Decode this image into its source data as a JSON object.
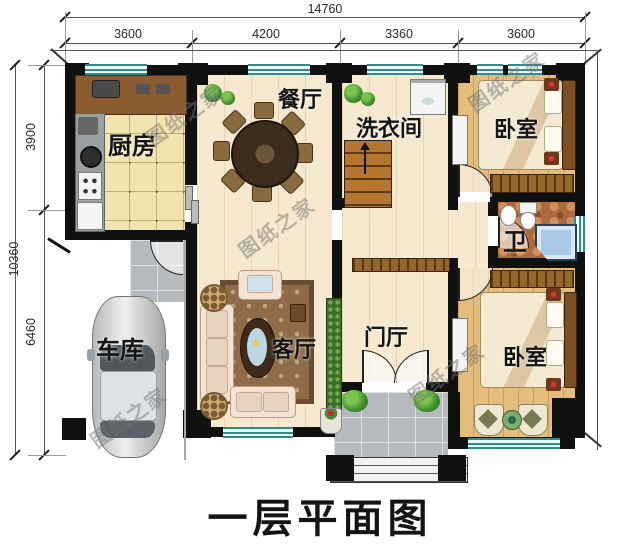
{
  "title": "一层平面图",
  "watermark": "图纸之家",
  "dims": {
    "top_total": "14760",
    "top_segments": [
      "3600",
      "4200",
      "3360",
      "3600"
    ],
    "left_total": "10360",
    "left_segments": [
      "3900",
      "6460"
    ]
  },
  "rooms": {
    "kitchen": "厨房",
    "dining": "餐厅",
    "laundry": "洗衣间",
    "bedroom_top": "卧室",
    "bath": "卫",
    "living": "客厅",
    "foyer": "门厅",
    "bedroom_bottom": "卧室",
    "garage": "车库"
  },
  "colors": {
    "wall": "#101010",
    "window_frame": "#2e8f89",
    "floor_wood": "#f6e9cf",
    "floor_bedroom": "#e4bd7c",
    "floor_kitchen": "#f2e4ae",
    "floor_bath": "#ad6a3e",
    "paving": "#b7babf",
    "tub": "#a9c9e9",
    "plant": "#3f8f2f"
  }
}
